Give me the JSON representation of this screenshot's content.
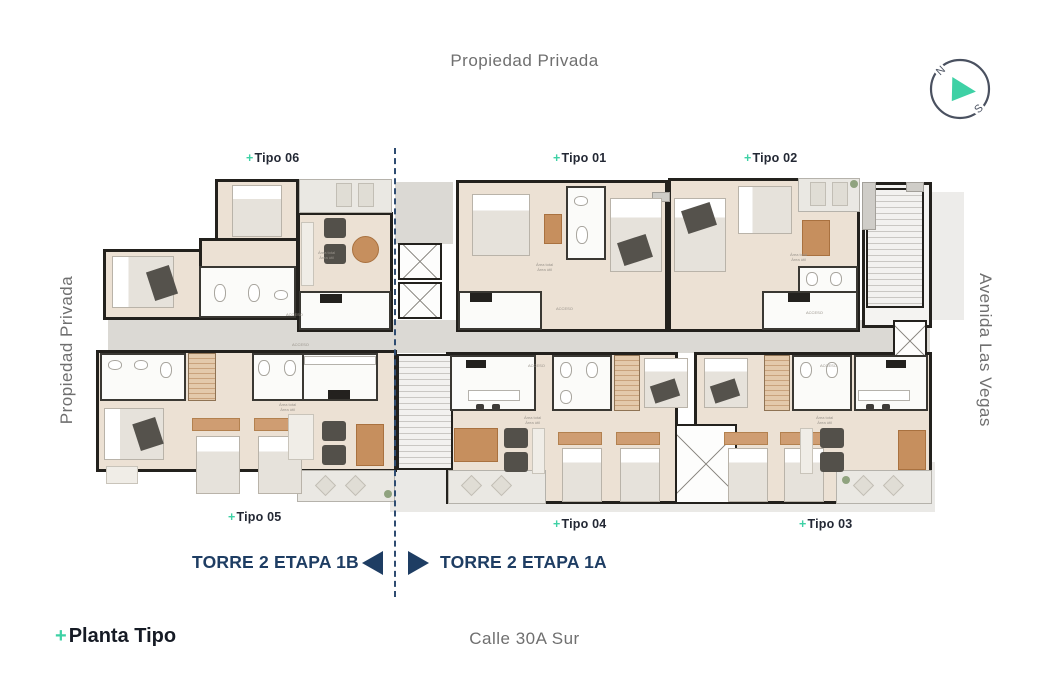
{
  "colors": {
    "teal": "#3ED1A5",
    "navy": "#1E3D63",
    "ink": "#232834",
    "street_gray": "#6F6F6F",
    "wall": "#23211D",
    "floor": "#ECE1D4",
    "corridor": "#DBD9D4",
    "wood": "#C68F5E"
  },
  "streets": {
    "top": "Propiedad Privada",
    "left": "Propiedad Privada",
    "right": "Avenida Las Vegas",
    "bottom": "Calle 30A Sur"
  },
  "compass": {
    "n": "N",
    "s": "S"
  },
  "divider": {
    "left": "TORRE 2 ETAPA 1B",
    "right": "TORRE 2 ETAPA 1A"
  },
  "footer": {
    "plus": "+",
    "label": "Planta Tipo"
  },
  "units": [
    {
      "key": "tipo-06",
      "plus": "+",
      "name": "Tipo 06"
    },
    {
      "key": "tipo-01",
      "plus": "+",
      "name": "Tipo 01"
    },
    {
      "key": "tipo-02",
      "plus": "+",
      "name": "Tipo 02"
    },
    {
      "key": "tipo-05",
      "plus": "+",
      "name": "Tipo 05"
    },
    {
      "key": "tipo-04",
      "plus": "+",
      "name": "Tipo 04"
    },
    {
      "key": "tipo-03",
      "plus": "+",
      "name": "Tipo 03"
    }
  ],
  "annotations": {
    "acceso": "ACCESO",
    "area1": "Área total",
    "area2": "Área útil"
  }
}
